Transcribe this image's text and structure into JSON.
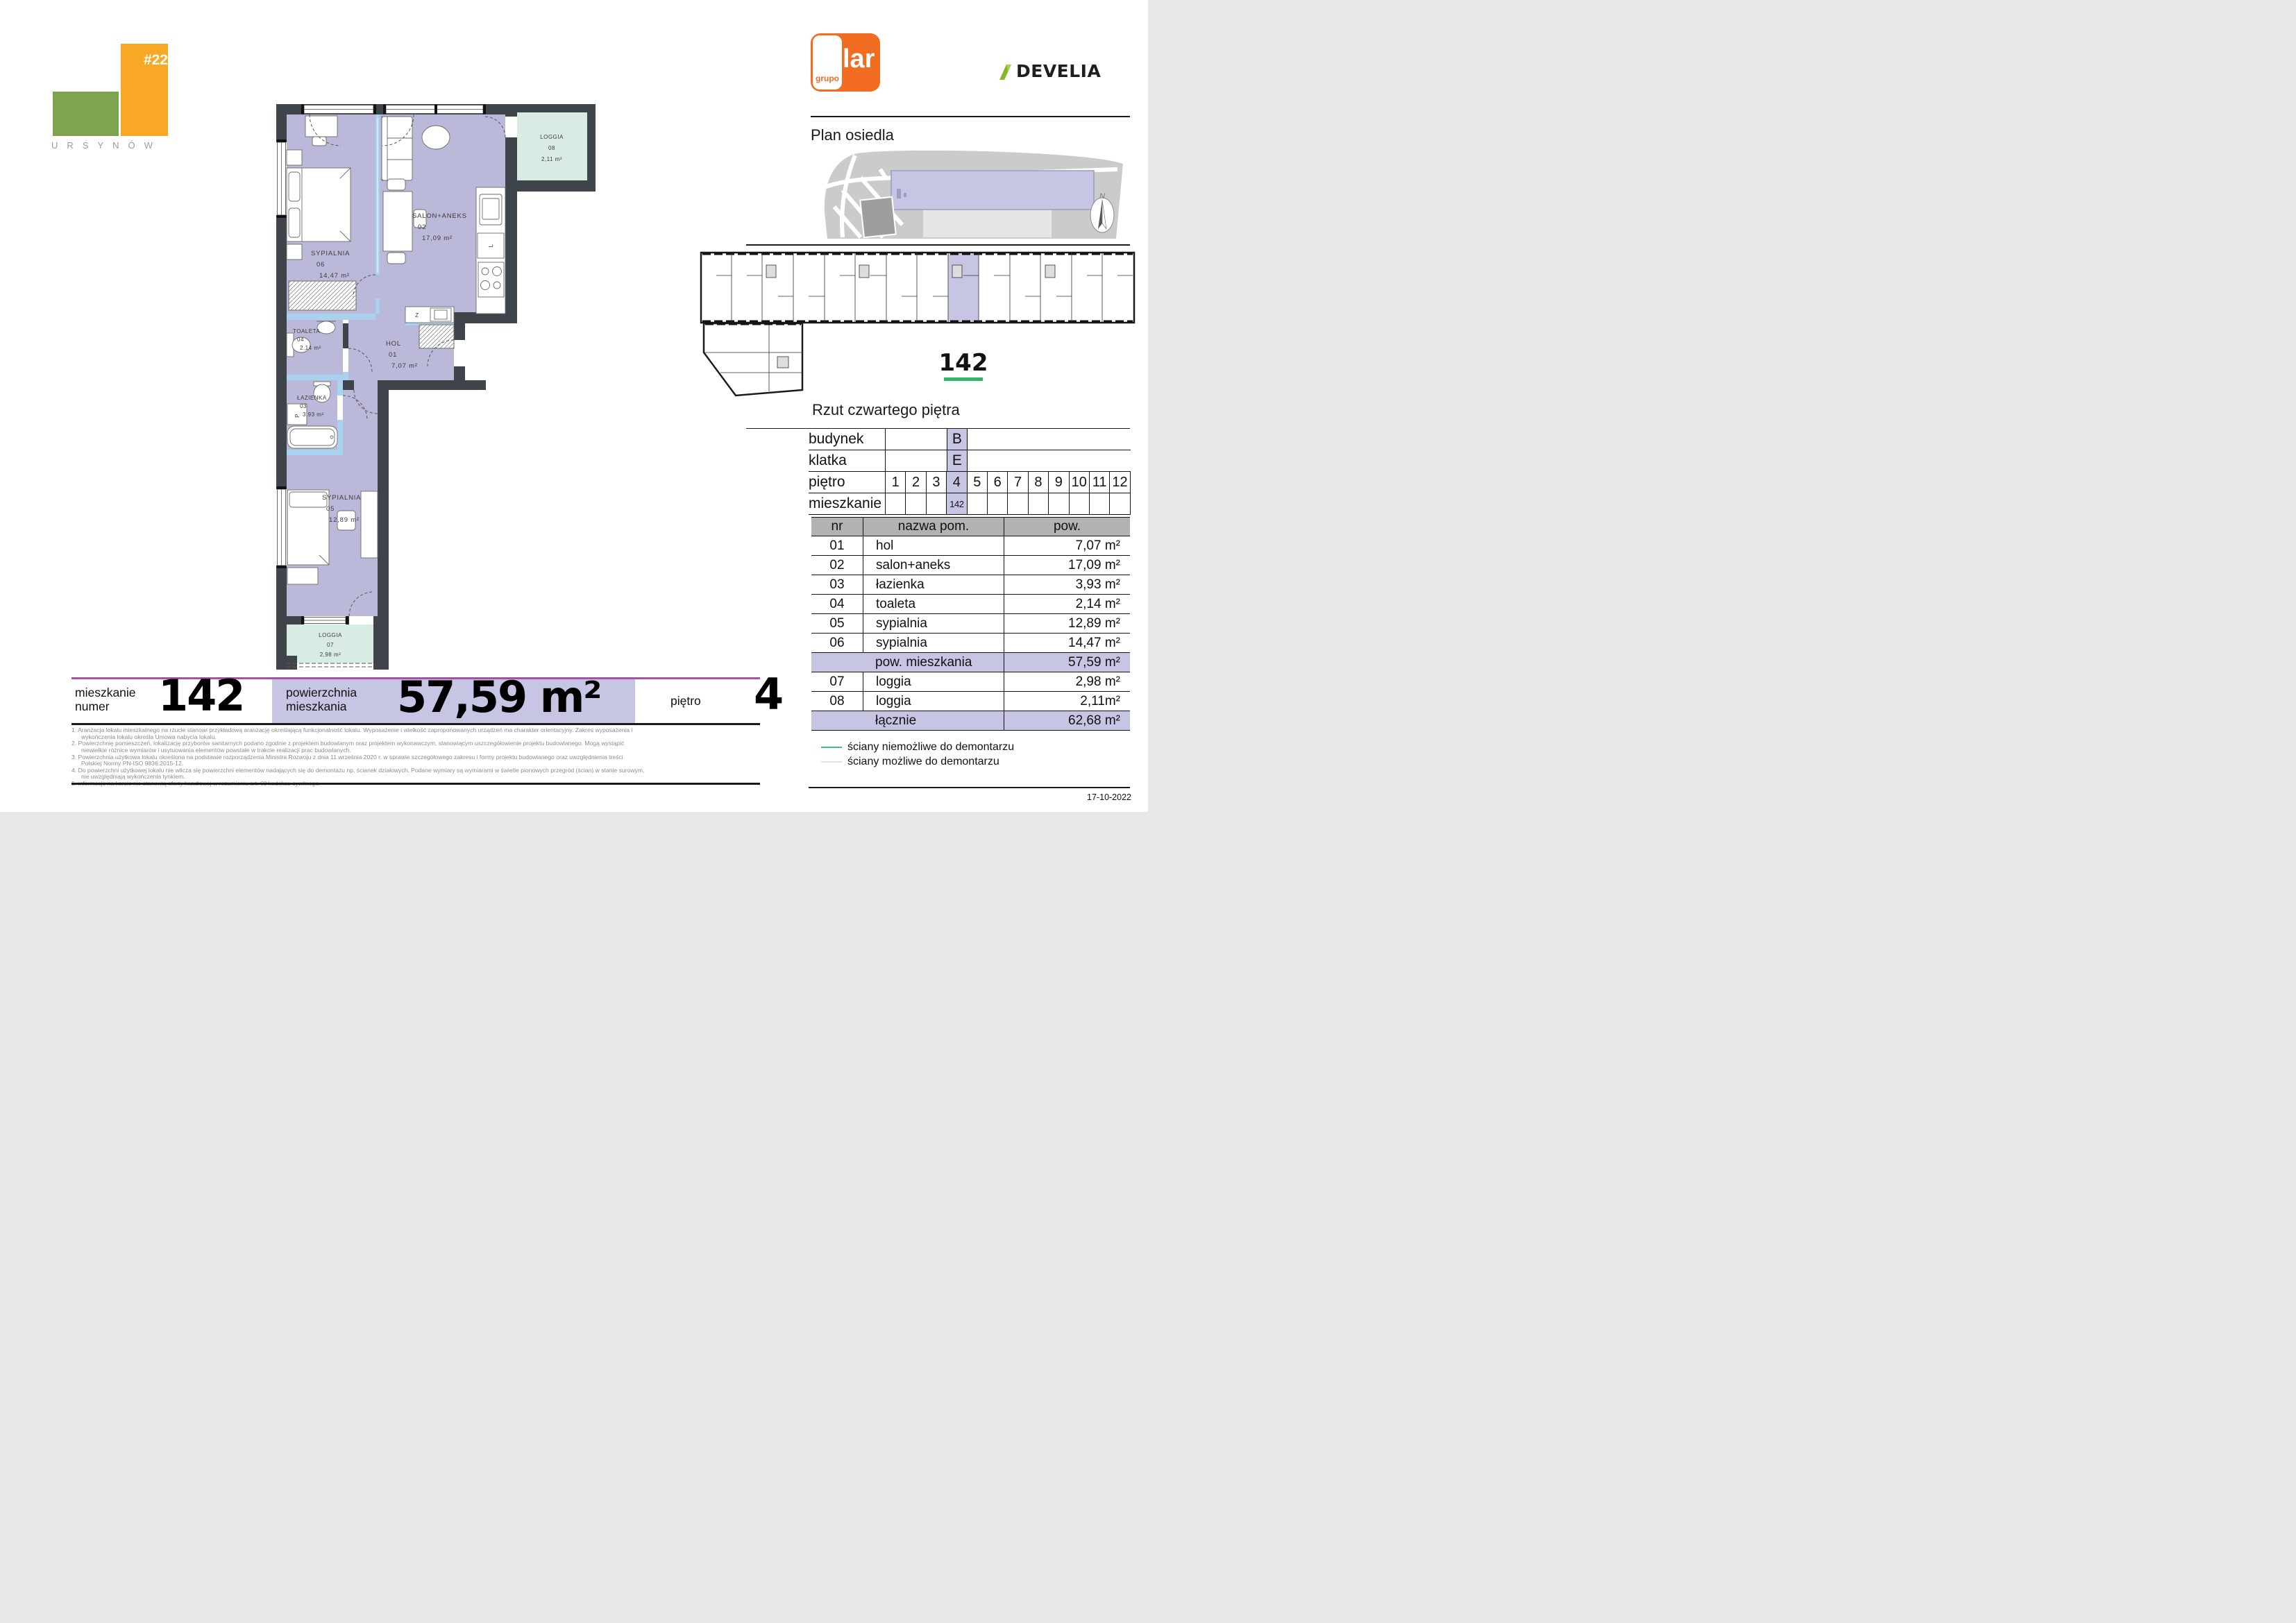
{
  "header": {
    "hash": "#22",
    "city": "URSYNÓW",
    "lar_small": "grupo",
    "lar_big": "lar",
    "develia": "DEVELIA"
  },
  "site": {
    "title": "Plan osiedla",
    "north": "N"
  },
  "overview": {
    "unit": "142",
    "caption": "Rzut czwartego piętra"
  },
  "location_table": {
    "row1_label": "budynek",
    "row1_value": "B",
    "row2_label": "klatka",
    "row2_value": "E",
    "row3_label": "piętro",
    "floors": [
      {
        "v": "1"
      },
      {
        "v": "2"
      },
      {
        "v": "3"
      },
      {
        "v": "4",
        "hl": true
      },
      {
        "v": "5"
      },
      {
        "v": "6"
      },
      {
        "v": "7"
      },
      {
        "v": "8"
      },
      {
        "v": "9"
      },
      {
        "v": "10"
      },
      {
        "v": "11"
      },
      {
        "v": "12"
      }
    ],
    "row4_label": "mieszkanie",
    "units": [
      {
        "v": ""
      },
      {
        "v": ""
      },
      {
        "v": ""
      },
      {
        "v": "142",
        "hl": true
      },
      {
        "v": ""
      },
      {
        "v": ""
      },
      {
        "v": ""
      },
      {
        "v": ""
      },
      {
        "v": ""
      },
      {
        "v": ""
      },
      {
        "v": ""
      },
      {
        "v": ""
      }
    ]
  },
  "rooms_table": {
    "headers": {
      "nr": "nr",
      "name": "nazwa pom.",
      "area": "pow."
    },
    "rows": [
      {
        "no": "01",
        "name": "hol",
        "area": "7,07 m²"
      },
      {
        "no": "02",
        "name": "salon+aneks",
        "area": "17,09 m²"
      },
      {
        "no": "03",
        "name": "łazienka",
        "area": "3,93 m²"
      },
      {
        "no": "04",
        "name": "toaleta",
        "area": "2,14 m²"
      },
      {
        "no": "05",
        "name": "sypialnia",
        "area": "12,89 m²"
      },
      {
        "no": "06",
        "name": "sypialnia",
        "area": "14,47 m²"
      }
    ],
    "summary1": {
      "name": "pow. mieszkania",
      "area": "57,59 m²"
    },
    "rows2": [
      {
        "no": "07",
        "name": "loggia",
        "area": "2,98 m²"
      },
      {
        "no": "08",
        "name": "loggia",
        "area": "2,11m²"
      }
    ],
    "summary2": {
      "name": "łącznie",
      "area": "62,68 m²"
    }
  },
  "plan": {
    "salon": {
      "name": "SALON+ANEKS",
      "no": "02",
      "area": "17,09 m²"
    },
    "syp06": {
      "name": "SYPIALNIA",
      "no": "06",
      "area": "14,47 m²"
    },
    "toaleta": {
      "name": "TOALETA",
      "no": "04",
      "area": "2,14 m²"
    },
    "hol": {
      "name": "HOL",
      "no": "01",
      "area": "7,07 m²"
    },
    "lazienka": {
      "name": "ŁAZIENKA",
      "no": "03",
      "area": "3,93 m²"
    },
    "syp05": {
      "name": "SYPIALNIA",
      "no": "05",
      "area": "12,89 m²"
    },
    "loggia07": {
      "name": "LOGGIA",
      "no": "07",
      "area": "2,98 m²"
    },
    "loggia08": {
      "name": "LOGGIA",
      "no": "08",
      "area": "2,11 m²"
    },
    "kitchen_fridge": "L",
    "kitchen_z": "Z",
    "washer": "P"
  },
  "summary_bar": {
    "l1a": "mieszkanie",
    "l1b": "numer",
    "number": "142",
    "l2a": "powierzchnia",
    "l2b": "mieszkania",
    "area": "57,59 m²",
    "l3": "piętro",
    "floor": "4"
  },
  "legend": [
    {
      "color": "#3fbf83",
      "label": "ściany niemożliwe do demontarzu"
    },
    {
      "color": "#d9e7f3",
      "label": "ściany możliwe do demontarzu"
    }
  ],
  "footnotes": [
    {
      "text": "1. Aranżacja lokalu mieszkalnego na rzucie stanowi przykładową aranżację określającą funkcjonalność lokalu. Wyposażenie i wielkość zaproponowanych urządzeń ma charakter orientacyjny. Zakres wyposażenia i",
      "cont": false
    },
    {
      "text": "wykończenia lokalu określa Umowa nabycia lokalu.",
      "cont": true
    },
    {
      "text": "2. Powierzchnię pomieszczeń, lokalizację przyborów sanitarnych podano zgodnie z projektem budowlanym oraz projektem wykonawczym, stanowiącym uszczegółowienie projektu budowlanego. Mogą wystąpić",
      "cont": false
    },
    {
      "text": "niewielkie różnice wymiarów i usytuowania elementów powstałe w trakcie realizacji prac budowlanych.",
      "cont": true
    },
    {
      "text": "3. Powierzchnia użytkowa lokalu określona na podstawie rozporządzenia Ministra Rozwoju z dnia 11 września 2020 r. w sprawie szczegółowego zakresu i formy projektu budowlanego oraz uwzględnienia treści",
      "cont": false
    },
    {
      "text": "Polskiej Normy PN-ISO 9836:2015-12.",
      "cont": true
    },
    {
      "text": "4. Do powierzchni użytkowej lokalu nie wlicza się powierzchni elementów nadających się do demontażu np. ścianek działowych. Podane wymiary są wymiarami w świetle pionowych przegród (ścian) w stanie surowym,",
      "cont": false
    },
    {
      "text": "nie uwzględniają wykończenia tynkiem.",
      "cont": true
    },
    {
      "text": "5. informacje na karcie nie stanowią oferty handlowej w rozumieniu art. 60 kodeksu cywilnego.",
      "cont": false
    }
  ],
  "date": "17-10-2022",
  "colors": {
    "wall": "#3f434a",
    "floor": "#bab9da",
    "mint": "#d9ece3",
    "blue": "#a9d2ee",
    "hl": "#c6c5e3",
    "grayhdr": "#b2b2b2",
    "magenta": "#a3539f",
    "green": "#2eb866",
    "larorange": "#f26d21",
    "develia": "#85b829",
    "logogreen": "#7ea351",
    "logoorange": "#f8a824"
  }
}
